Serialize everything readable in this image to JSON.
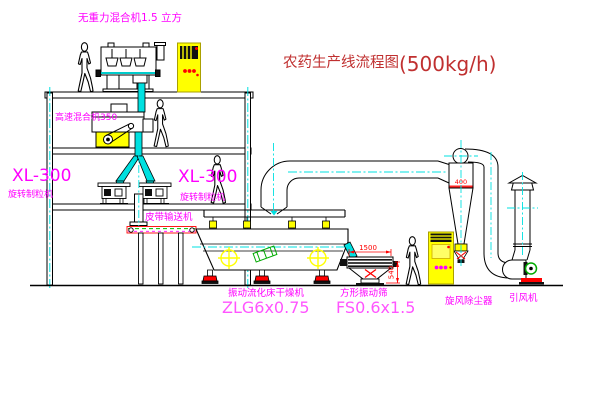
{
  "title": {
    "name": "农药生产线流程图",
    "capacity": "(500kg/h)"
  },
  "equipment": {
    "gravity_mixer": {
      "label": "无重力混合机1.5 立方"
    },
    "high_speed_mixer": {
      "label": "高速混合机350"
    },
    "granulator_left": {
      "model": "XL-300",
      "label": "旋转制粒机"
    },
    "granulator_right": {
      "model": "XL-300",
      "label": "旋转制粒机"
    },
    "belt_conveyor": {
      "label": "皮带输送机"
    },
    "fluid_bed_dryer": {
      "label": "振动流化床干燥机",
      "model": "ZLG6x0.75"
    },
    "vibrating_screen": {
      "label": "方形振动筛",
      "model": "FS0.6x1.5",
      "dim_width": "1500",
      "dim_height": "540"
    },
    "cyclone": {
      "label": "旋风除尘器",
      "dim": "400"
    },
    "fan": {
      "label": "引风机"
    }
  },
  "colors": {
    "label_magenta": "#ff00ff",
    "model_pink": "#ff55ff",
    "title_red": "#c03030",
    "dim_red": "#ff0000",
    "centerline_cyan": "#00e0e0",
    "accent_yellow": "#ffff00",
    "accent_green": "#00bb00"
  }
}
